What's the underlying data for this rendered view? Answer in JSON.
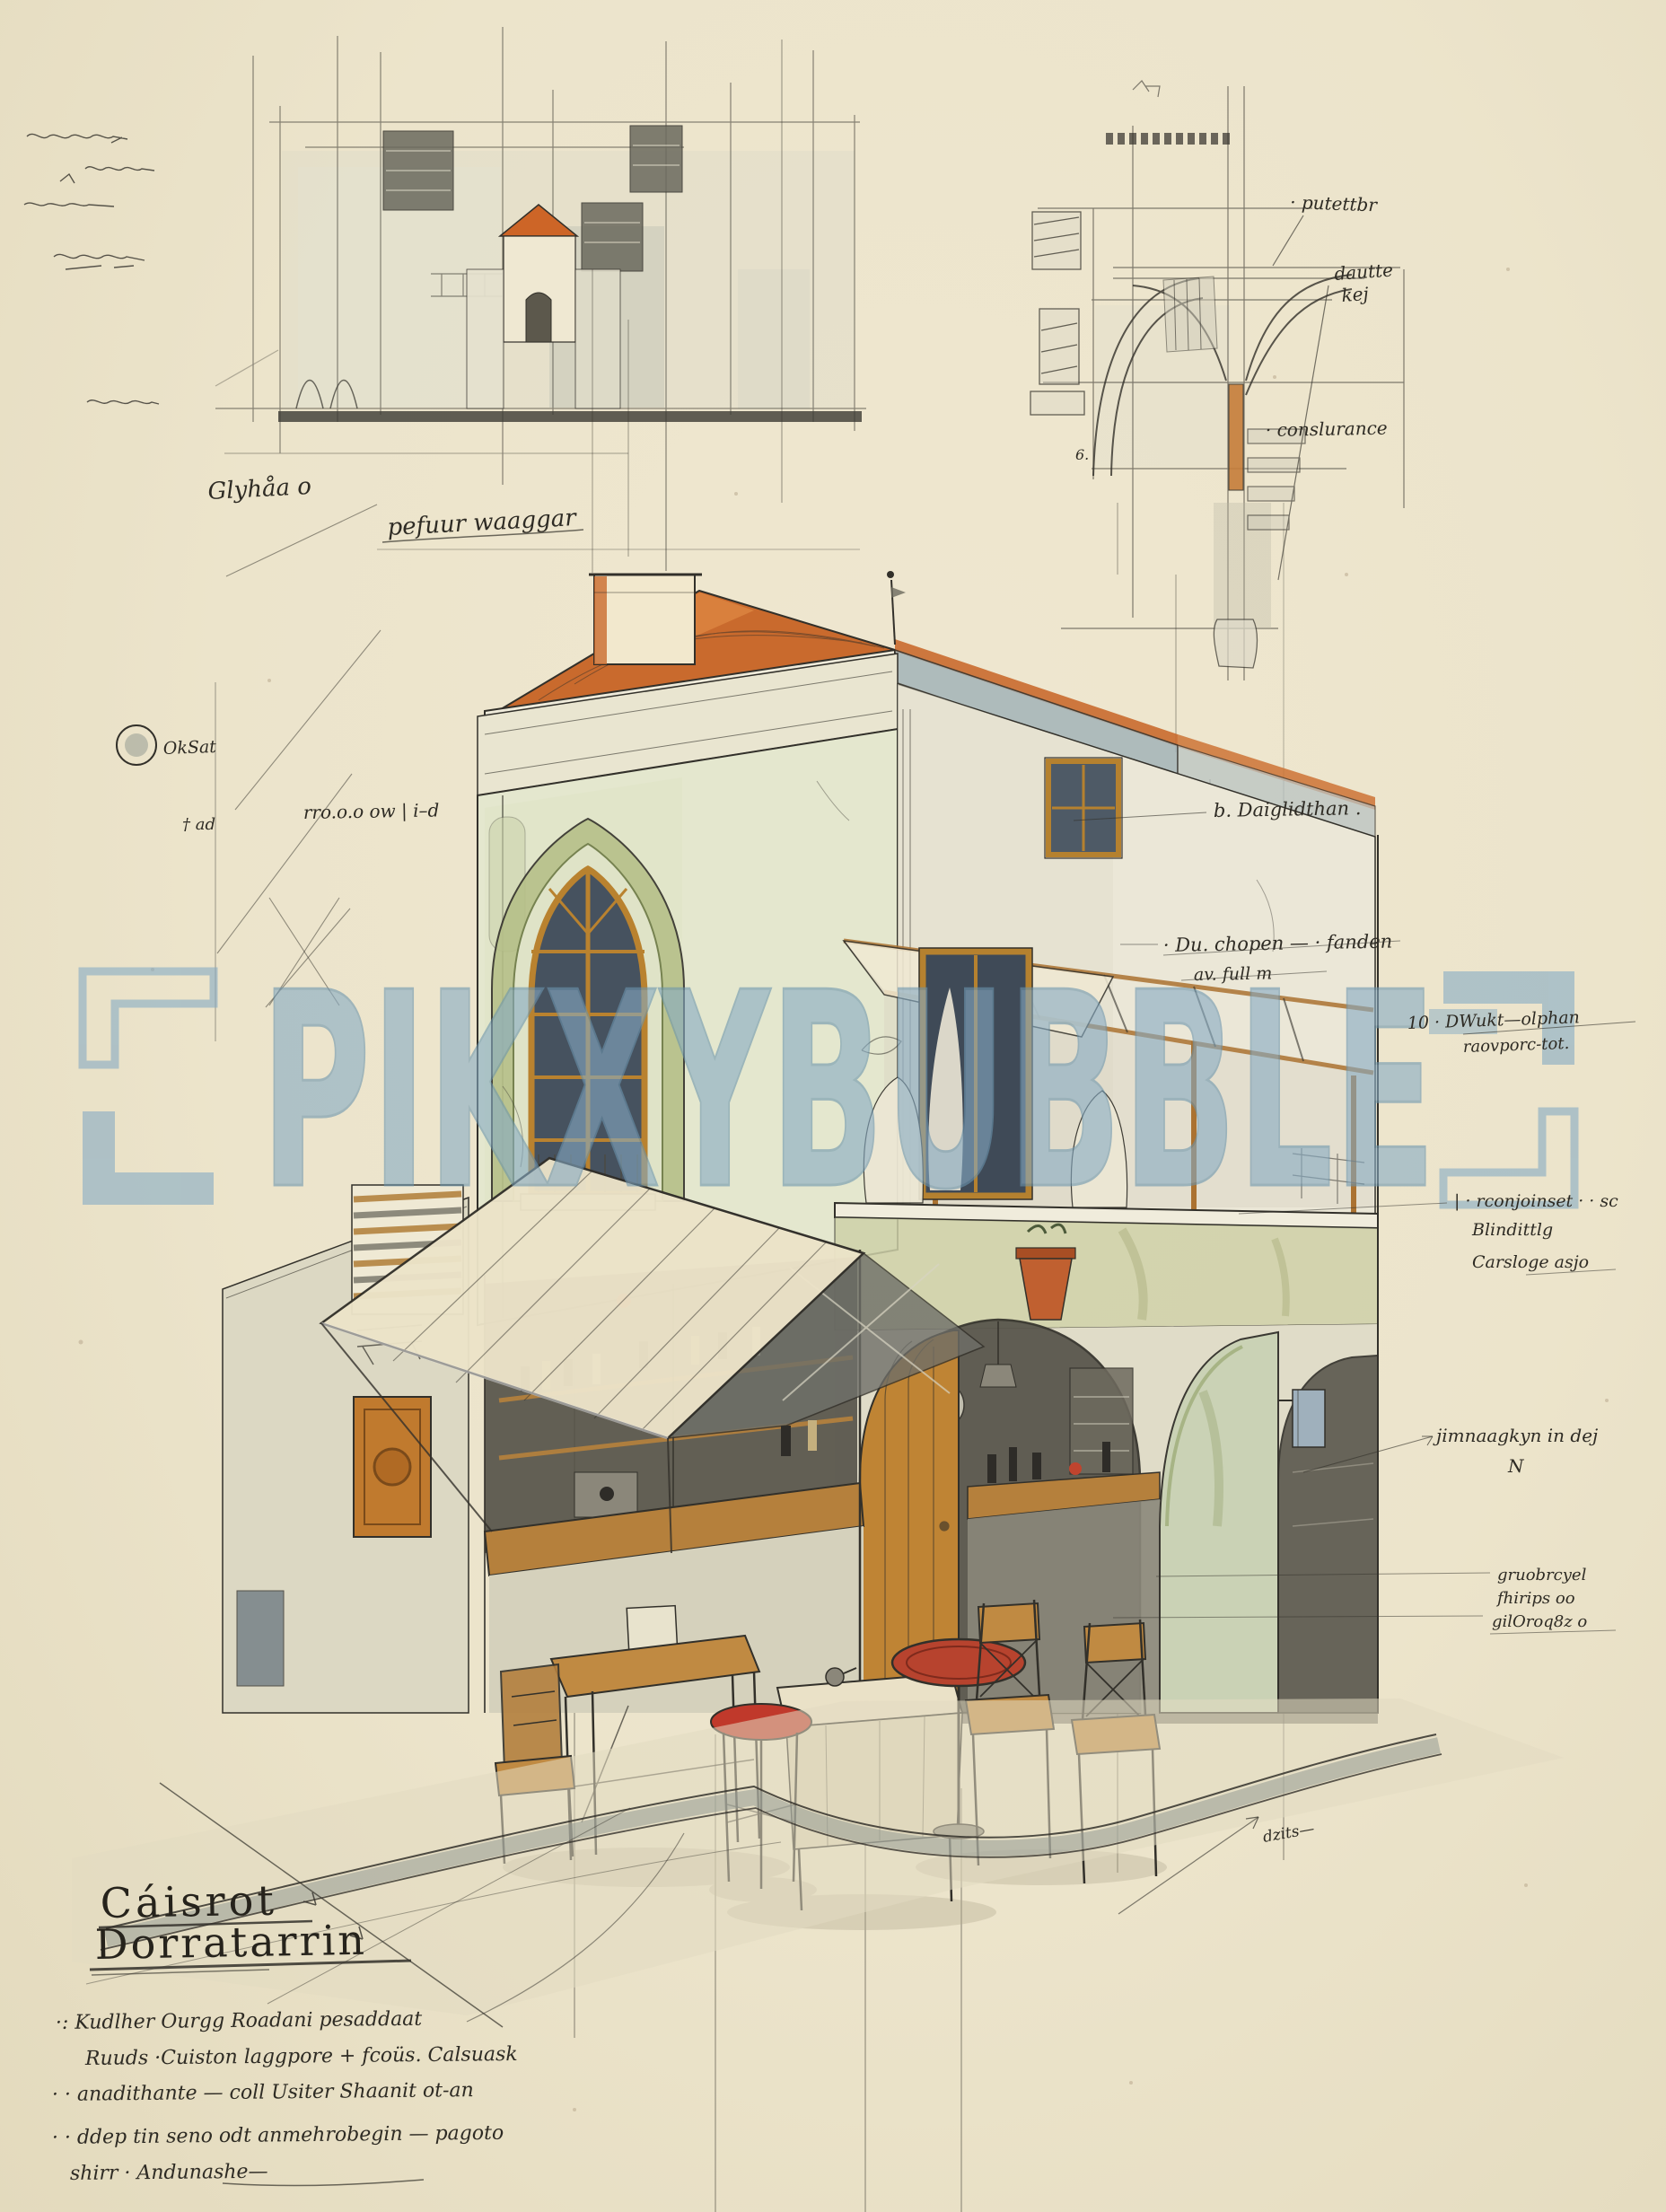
{
  "watermark": {
    "text": "PIKXYBUBBLE",
    "color": "#86abc4"
  },
  "title_block": {
    "line1": "Cáisrot",
    "line2": "Dorratarrin"
  },
  "notes": {
    "n1": "·: Kudlher Ourgg  Roadani  pesaddaat",
    "n2": "Ruuds  ·Cuiston laggpore  + fcoüs.  Calsuask",
    "n3": "· · anadithante  — coll Usiter Shaanit ot-an",
    "n4": "· · ddep tin  seno  odt  anmehrobegin  — pagoto",
    "n5": "shirr  · Andunashe—"
  },
  "annotations": {
    "elevation_label": "Glyhåa o",
    "elevation_caption": "pefuur waaggar",
    "detail_note_top": "· putettbr",
    "detail_note_mid1": "dautte",
    "detail_note_mid2": "kej",
    "detail_note_bottom": "· conslurance",
    "detail_dim": "6.",
    "plan_marker": "OkSat",
    "datum_note": "† ad",
    "baseline_note": "rro.o.o ow  |  i–d",
    "roof_note": "b. Daiglidthan .",
    "pergola_note1": "· Du. chopen — · fanden",
    "pergola_note2": "av. full  m",
    "ref_note1": "10 · DWukt—olphan",
    "ref_note2": "raovporc-tot.",
    "materials_note1": "| · rconjoinset · · sc",
    "materials_note2": "Blindittlg",
    "materials_note3": "Carsloge asjo",
    "ground_note1": "jimnaagkyn  in dej",
    "ground_note2": "N",
    "corner_note1": "gruobrcyel",
    "corner_note2": "fhirips oo",
    "corner_note3": "gilOroq8z o",
    "curb_note": "dzits—"
  },
  "colors": {
    "paper": "#ebe3ca",
    "ink": "#32302a",
    "roof": "#c96a2d",
    "wall_green": "#e4e7ce",
    "wall_cream": "#ebe7d7",
    "fascia_blue": "#a3b3b8",
    "wood": "#b5803c",
    "awning": "#ece3c8",
    "accent_red": "#c0392b",
    "wash_gray": "#cfd0c4",
    "watermark": "#86abc4"
  }
}
